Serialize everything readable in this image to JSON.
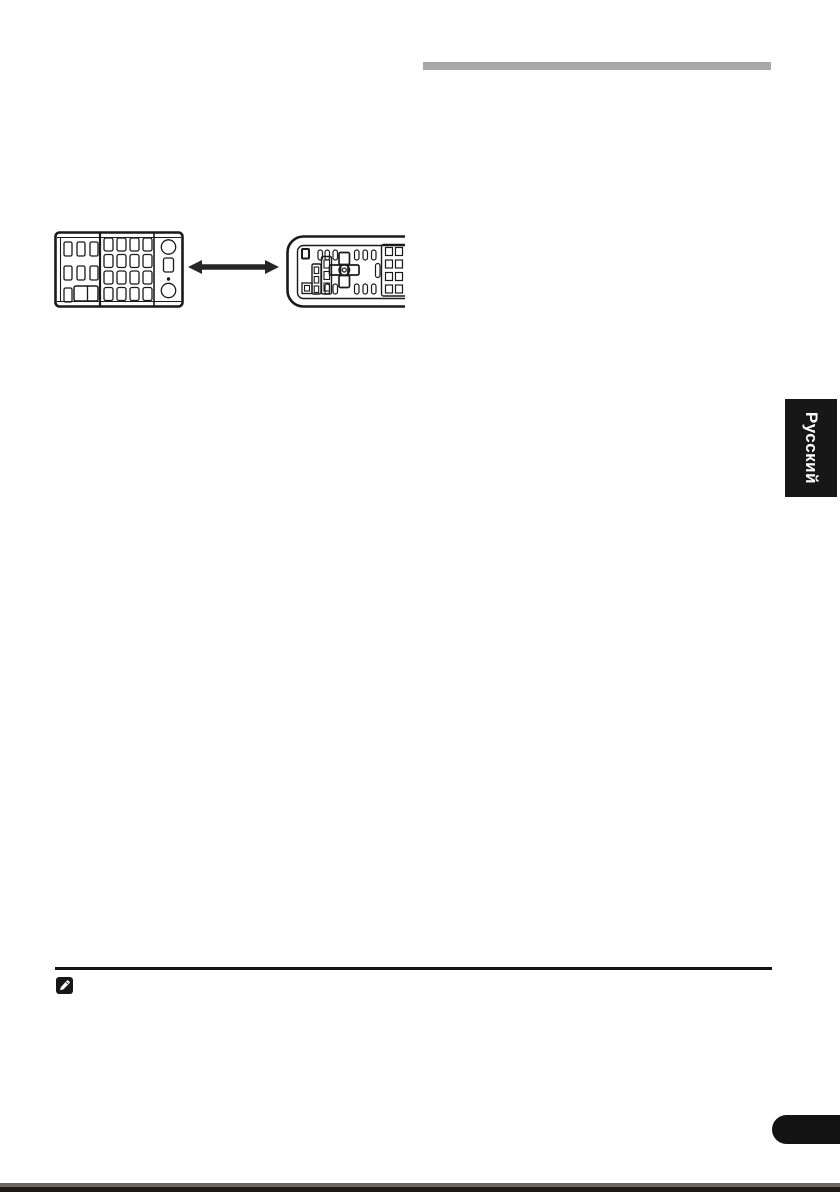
{
  "page": {
    "background_color": "#ffffff",
    "bottom_edge_color": "#1c1a18"
  },
  "heading_bar": {
    "color": "#a8a8a8"
  },
  "figure": {
    "left_remote_icon": "remote-control-front",
    "arrow_icon": "double-headed-arrow",
    "right_remote_icon": "remote-control-reverse-side",
    "line_color": "#1a1a1a"
  },
  "language_tab": {
    "label": "Русский",
    "background_color": "#171717",
    "text_color": "#ffffff"
  },
  "note": {
    "icon": "pencil-note-icon",
    "icon_background": "#171717",
    "rule_color": "#131313"
  },
  "page_marker": {
    "color": "#131313"
  }
}
